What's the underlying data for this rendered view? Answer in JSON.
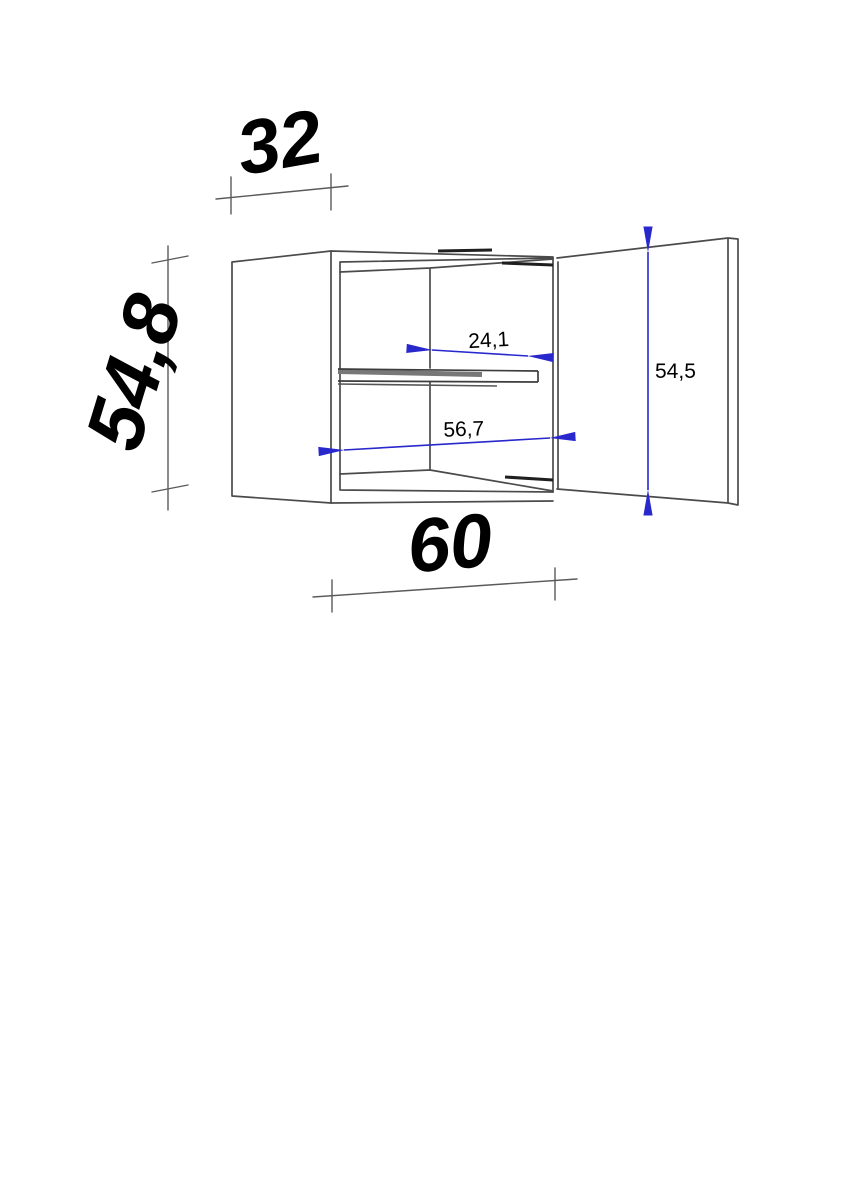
{
  "drawing": {
    "background": "#ffffff",
    "colors": {
      "line": "#4b4b4b",
      "dark_line": "#1f1f1f",
      "shelf_shadow": "#787878",
      "dimension_gray": "#5a5a5a",
      "dimension_blue": "#2828cd",
      "text": "#000000"
    },
    "outer_dimensions": {
      "depth": {
        "label": "32"
      },
      "height": {
        "label": "54,8"
      },
      "width": {
        "label": "60"
      }
    },
    "inner_dimensions": {
      "interior_depth": {
        "label": "24,1"
      },
      "interior_width": {
        "label": "56,7"
      },
      "door_height": {
        "label": "54,5"
      }
    }
  }
}
